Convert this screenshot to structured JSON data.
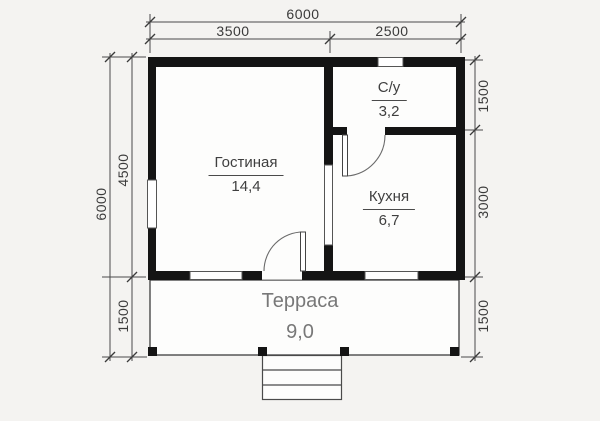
{
  "plan": {
    "dimensions": {
      "top": {
        "total": "6000",
        "left_span": "3500",
        "right_span": "2500"
      },
      "left": {
        "total": "6000",
        "upper": "4500",
        "lower": "1500"
      },
      "right": {
        "upper": "1500",
        "middle": "3000",
        "lower": "1500"
      }
    },
    "rooms": {
      "living": {
        "name": "Гостиная",
        "area": "14,4"
      },
      "bathroom": {
        "name": "С/у",
        "area": "3,2"
      },
      "kitchen": {
        "name": "Кухня",
        "area": "6,7"
      },
      "terrace": {
        "name": "Терраса",
        "area": "9,0"
      }
    },
    "colors": {
      "wall": "#141414",
      "thin_line": "#4a4a4a",
      "dim_text": "#3a3a3a",
      "room_text": "#3f3f3f",
      "terrace_text": "#787878",
      "background": "#f4f3f1",
      "floor": "#fdfdfc"
    }
  }
}
